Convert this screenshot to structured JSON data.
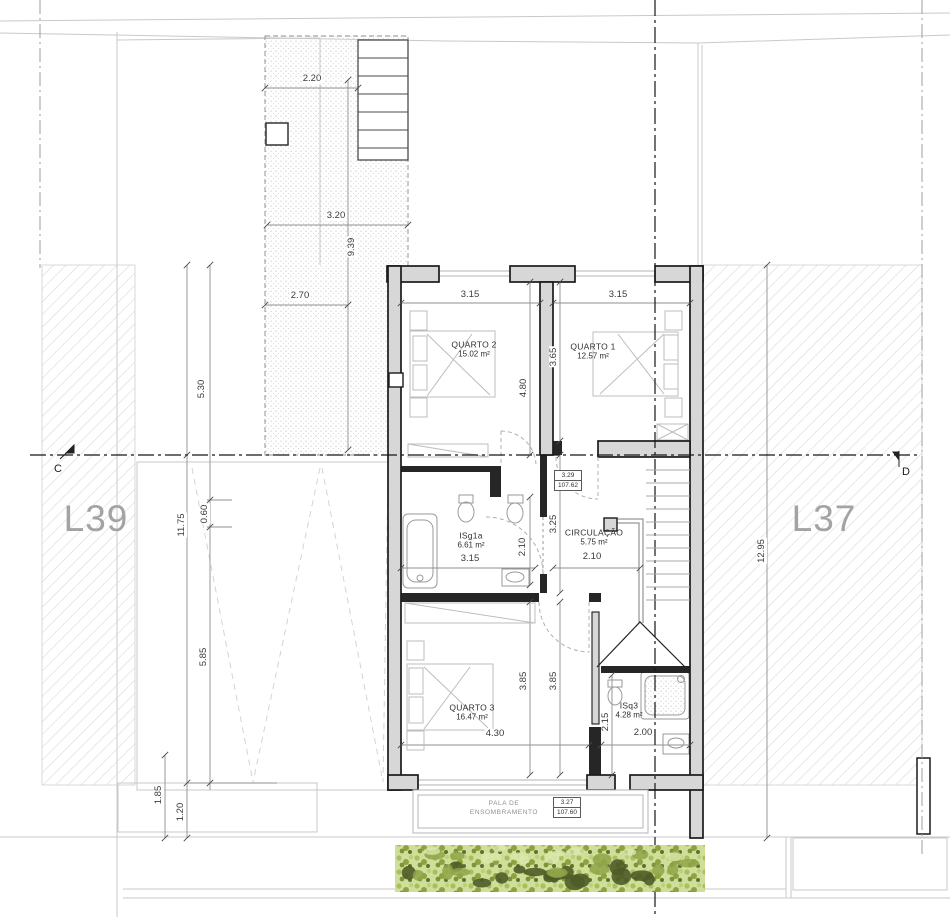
{
  "lots": {
    "left": "L39",
    "right": "L37"
  },
  "sections": {
    "left": "C",
    "right": "D"
  },
  "rooms": {
    "quarto2": {
      "name": "QUARTO 2",
      "area": "15.02 m²"
    },
    "quarto1": {
      "name": "QUARTO 1",
      "area": "12.57 m²"
    },
    "isg1a": {
      "name": "ISg1a",
      "area": "6.61 m²"
    },
    "circulacao": {
      "name": "CIRCULAÇÃO",
      "area": "5.75 m²"
    },
    "quarto3": {
      "name": "QUARTO 3",
      "area": "16.47 m²"
    },
    "isq3": {
      "name": "ISq3",
      "area": "4.28 m²"
    },
    "pala": {
      "line1": "PALA DE",
      "line2": "ENSOMBRAMENTO"
    }
  },
  "levels": {
    "upper": {
      "height": "3.29",
      "elevation": "107.62"
    },
    "lower": {
      "height": "3.27",
      "elevation": "107.60"
    }
  },
  "dims": {
    "d220": "2.20",
    "d320": "3.20",
    "d939": "9.39",
    "d270": "2.70",
    "q2w": "3.15",
    "q1w": "3.15",
    "q2d": "4.80",
    "q1d": "3.65",
    "l530": "5.30",
    "l1175": "11.75",
    "l060": "0.60",
    "l585": "5.85",
    "l185": "1.85",
    "l120": "1.20",
    "r1295": "12.95",
    "b1w": "3.15",
    "b1d": "2.10",
    "c325": "3.25",
    "cw": "2.10",
    "q3da": "3.85",
    "q3db": "3.85",
    "q3w": "4.30",
    "b3d": "2.15",
    "b3w": "2.00"
  },
  "colors": {
    "wall_fill": "#d7d7d7",
    "wall_stroke": "#1b1b1b",
    "partition": "#262626",
    "dim_line": "#8f8f8f",
    "site_line": "#c9c9c9",
    "hedge_base": "#cfdf9a",
    "hedge_dark": "#4f5c27",
    "lot_text": "#a3a3a3"
  }
}
